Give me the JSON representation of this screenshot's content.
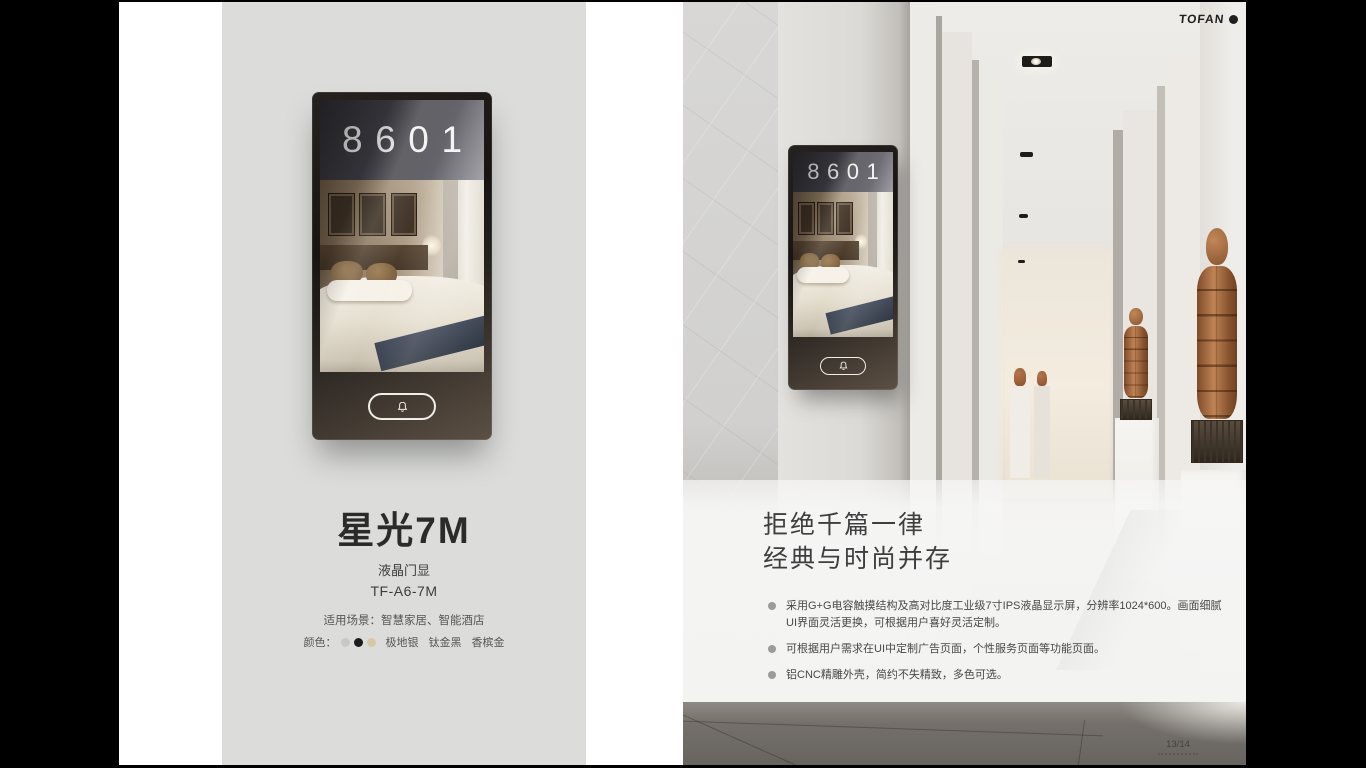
{
  "brand": {
    "name": "TOFAN"
  },
  "left_page": {
    "device": {
      "room_number": "8601",
      "bell_icon": "bell"
    },
    "product_name": "星光7M",
    "product_type": "液晶门显",
    "model": "TF-A6-7M",
    "scene": "适用场景：智慧家居、智能酒店",
    "colors_label": "颜色：",
    "color_options": [
      {
        "name": "极地银",
        "hex": "#c8c8c6"
      },
      {
        "name": "钛金黑",
        "hex": "#1c1c1c"
      },
      {
        "name": "香槟金",
        "hex": "#d8c9a6"
      }
    ]
  },
  "right_page": {
    "device": {
      "room_number": "8601"
    },
    "headline": {
      "line1": "拒绝千篇一律",
      "line2": "经典与时尚并存"
    },
    "bullets": [
      "采用G+G电容触摸结构及高对比度工业级7寸IPS液晶显示屏，分辨率1024*600。画面细腻UI界面灵活更换，可根据用户喜好灵活定制。",
      "可根据用户需求在UI中定制广告页面，个性服务页面等功能页面。",
      "铝CNC精雕外壳，简约不失精致，多色可选。"
    ],
    "page_number": "13/14"
  }
}
